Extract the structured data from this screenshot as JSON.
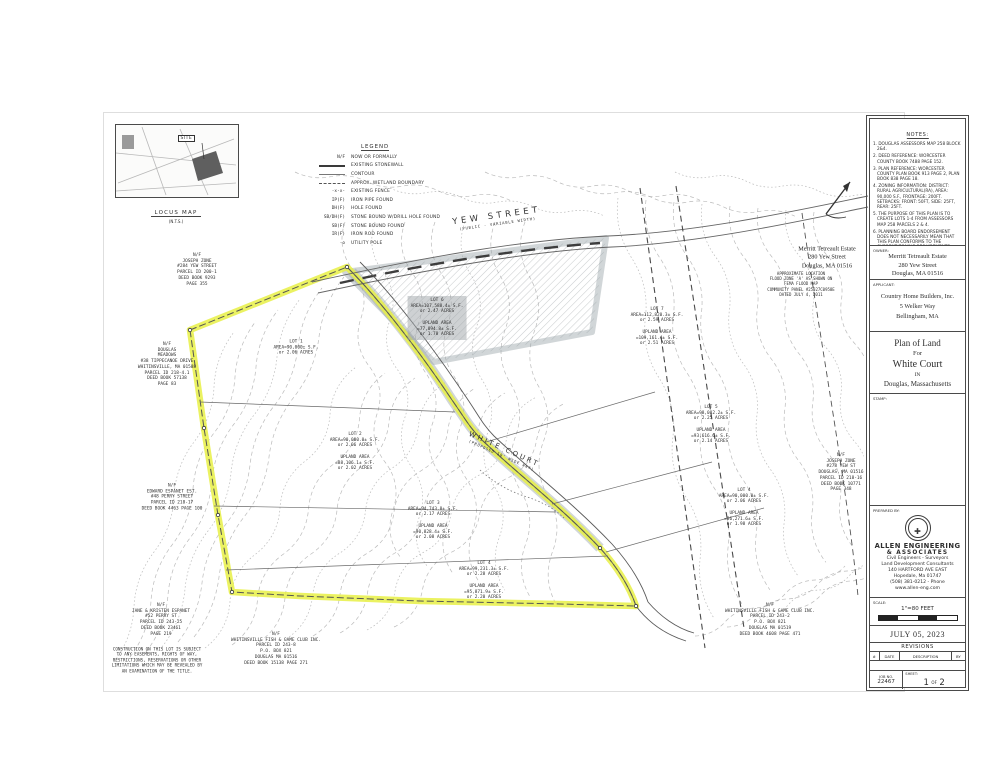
{
  "locus": {
    "site_label": "SITE",
    "caption": "LOCUS MAP",
    "scale_note": "(N.T.S.)"
  },
  "legend": {
    "title": "LEGEND",
    "items": [
      {
        "sym": "N/F",
        "type": "text",
        "label": "NOW OR FORMALLY"
      },
      {
        "sym": "",
        "type": "stonewall",
        "label": "EXISTING STONEWALL"
      },
      {
        "sym": "",
        "type": "contour",
        "label": "CONTOUR"
      },
      {
        "sym": "",
        "type": "wetland",
        "label": "APPROX. WETLAND BOUNDARY"
      },
      {
        "sym": "-x-x-",
        "type": "text",
        "label": "EXISTING FENCE"
      },
      {
        "sym": "IP(F)",
        "type": "text",
        "label": "IRON PIPE FOUND"
      },
      {
        "sym": "DH(F)",
        "type": "text",
        "label": "HOLE FOUND"
      },
      {
        "sym": "SB/DH(F)",
        "type": "text",
        "label": "STONE BOUND W/DRILL HOLE FOUND"
      },
      {
        "sym": "SB(F)",
        "type": "text",
        "label": "STONE BOUND FOUND"
      },
      {
        "sym": "IR(F)",
        "type": "text",
        "label": "IRON ROD FOUND"
      },
      {
        "sym": "-o",
        "type": "text",
        "label": "UTILITY POLE"
      }
    ]
  },
  "notes": {
    "title": "NOTES:",
    "items": [
      "1. DOUGLAS ASSESSORS MAP 258 BLOCK 2&4.",
      "2. DEED REFERENCE: WORCESTER COUNTY BOOK 7488 PAGE 152.",
      "3. PLAN REFERENCE: WORCESTER COUNTY PLAN BOOK 913 PAGE 2, PLAN BOOK 838 PAGE 18.",
      "4. ZONING INFORMATION: DISTRICT: RURAL AGRICULTURAL(RA), AREA: 90,000 S.F., FRONTAGE: 200FT. SETBACKS: FRONT: 50FT, SIDE: 25FT, REAR: 25FT.",
      "5. THE PURPOSE OF THIS PLAN IS TO CREATE LOTS 1-4 FROM ASSESSORS MAP 258 PARCELS 2 & 4.",
      "6. PLANNING BOARD ENDORSEMENT DOES NOT NECESSARILY MEAN THAT THIS PLAN CONFORMS TO THE CURRENT ZONING REQUIREMENTS.",
      "7. HORIZONTAL DATUM IS NORTH AMERICAN 1983. VERTICAL DATUM IS NORTH AMERICAN 1988."
    ]
  },
  "owner": {
    "label": "OWNER:",
    "lines": [
      "Merritt Tetreault Estate",
      "280 Yew Street",
      "Douglas, MA 01516"
    ]
  },
  "applicant": {
    "label": "APPLICANT:",
    "lines": [
      "Country Home Builders, Inc.",
      "5 Welker Way",
      "Bellingham, MA"
    ]
  },
  "title_block": {
    "line1": "Plan of Land",
    "line2": "For",
    "line3": "White Court",
    "line4": "IN",
    "line5": "Douglas, Massachusetts"
  },
  "stamp": {
    "label": "STAMP:"
  },
  "prepared_by": {
    "label": "PREPARED BY:",
    "company_line1": "ALLEN ENGINEERING",
    "company_line2": "& ASSOCIATES",
    "tagline1": "Civil Engineers - Surveyors",
    "tagline2": "Land Development Consultants",
    "address1": "140 HARTFORD AVE EAST",
    "address2": "Hopedale, Ma 01747",
    "phone": "(508) 381-0212  -  Phone",
    "web": "www.allen-eng.com"
  },
  "scale_block": {
    "label": "SCALE:",
    "value": "1\"=80 FEET"
  },
  "date_block": {
    "date": "JULY 05, 2023"
  },
  "revisions": {
    "title": "REVISIONS",
    "col_num": "#",
    "col_date": "DATE",
    "col_desc": "DESCRIPTION",
    "col_by": "BY"
  },
  "job_block": {
    "label": "JOB NO.",
    "number": "22467",
    "sheet_label": "SHEET:",
    "sheet_num": "1",
    "of": "OF",
    "sheet_total": "2"
  },
  "plan": {
    "yew_street": {
      "name": "YEW STREET",
      "sub": "(PUBLIC - VARIABLE WIDTH)"
    },
    "white_court": {
      "name": "WHITE COURT",
      "sub": "(PROPOSED 50' WIDE WAY)"
    },
    "lots": [
      {
        "lines": [
          "LOT 1",
          "AREA=90,000± S.F.",
          "or 2.06 ACRES"
        ]
      },
      {
        "lines": [
          "LOT 2",
          "AREA=90,000.0± S.F.",
          "or 2.06 ACRES",
          "",
          "UPLAND AREA",
          "=88,106.1± S.F.",
          "or 2.02 ACRES"
        ]
      },
      {
        "lines": [
          "LOT 3",
          "AREA=94,743.8± S.F.",
          "or 2.17 ACRES",
          "",
          "UPLAND AREA",
          "=90,828.4± S.F.",
          "or 2.08 ACRES"
        ]
      },
      {
        "lines": [
          "LOT 4",
          "AREA=99,231.3± S.F.",
          "or 2.28 ACRES",
          "",
          "UPLAND AREA",
          "=95,871.9± S.F.",
          "or 2.20 ACRES"
        ]
      },
      {
        "lines": [
          "LOT 5",
          "AREA=98,082.2± S.F.",
          "or 2.25 ACRES",
          "",
          "UPLAND AREA",
          "=93,616.6± S.F.",
          "or 2.14 ACRES"
        ]
      },
      {
        "lines": [
          "LOT 4",
          "AREA=90,000.0± S.F.",
          "or 2.06 ACRES",
          "",
          "UPLAND AREA",
          "=86,271.6± S.F.",
          "or 1.98 ACRES"
        ]
      },
      {
        "lines": [
          "LOT 7",
          "AREA=112,820.3± S.F.",
          "or 2.59 ACRES",
          "",
          "UPLAND AREA",
          "=109,161.4± S.F.",
          "or 2.51 ACRES"
        ]
      },
      {
        "lines": [
          "LOT 6",
          "AREA=107,588.4± S.F.",
          "or 2.47 ACRES",
          "",
          "UPLAND AREA",
          "=77,094.8± S.F.",
          "or 1.78 ACRES"
        ]
      }
    ],
    "abutters": [
      {
        "lines": [
          "N/F",
          "JOSEPH ZONE",
          "#284 YEW STREET",
          "PARCEL ID 200-1",
          "DEED BOOK 9293",
          "PAGE 355"
        ]
      },
      {
        "lines": [
          "N/F",
          "DOUGLAS",
          "MEADOWS",
          "#38 TIPPECANOE DRIVE",
          "WHITINSVILLE, MA 01588",
          "PARCEL ID 218-4.1",
          "DEED BOOK 57138",
          "PAGE 83"
        ]
      },
      {
        "lines": [
          "N/F",
          "EDWARD ESPANET EST.",
          "#48 PERRY STREET",
          "PARCEL ID 218-17",
          "DEED BOOK 4463 PAGE 100"
        ]
      },
      {
        "lines": [
          "N/F",
          "JANE & KRISTEN ESPANET",
          "#52 PERRY ST",
          "PARCEL ID 243-25",
          "DEED BOOK 23461",
          "PAGE 219"
        ]
      },
      {
        "lines": [
          "N/F",
          "WHITINSVILLE FISH & GAME CLUB INC.",
          "PARCEL ID 243-8",
          "P.O. BOX 821",
          "DOUGLAS MA 01516",
          "DEED BOOK 15138 PAGE 271"
        ]
      },
      {
        "lines": [
          "N/F",
          "WHITINSVILLE FISH & GAME CLUB INC.",
          "PARCEL ID 243-2",
          "P.O. BOX 821",
          "DOUGLAS MA 01519",
          "DEED BOOK 4608 PAGE 471"
        ]
      },
      {
        "lines": [
          "N/F",
          "JOSEPH ZONE",
          "#278 YEW ST",
          "DOUGLAS, MA 01516",
          "PARCEL ID 218-16",
          "DEED BOOK 10771",
          "PAGE 348"
        ]
      }
    ],
    "flood_note": {
      "lines": [
        "APPROXIMATE LOCATION",
        "FLOOD ZONE 'A' AS SHOWN ON",
        "FEMA FLOOD MAP",
        "COMMUNITY PANEL #25027C0958E",
        "DATED JULY 4, 2011"
      ]
    },
    "construction_note": {
      "lines": [
        "CONSTRUCTION ON THIS LOT IS SUBJECT",
        "TO ANY EASEMENTS, RIGHTS OF WAY,",
        "RESTRICTIONS, RESERVATIONS OR OTHER",
        "LIMITATIONS WHICH MAY BE REVEALED BY",
        "AN EXAMINATION OF THE TITLE."
      ]
    },
    "owner_onplan": {
      "lines": [
        "Merritt Tetreault Estate",
        "280 Yew Street",
        "Douglas, MA 01516"
      ]
    }
  }
}
